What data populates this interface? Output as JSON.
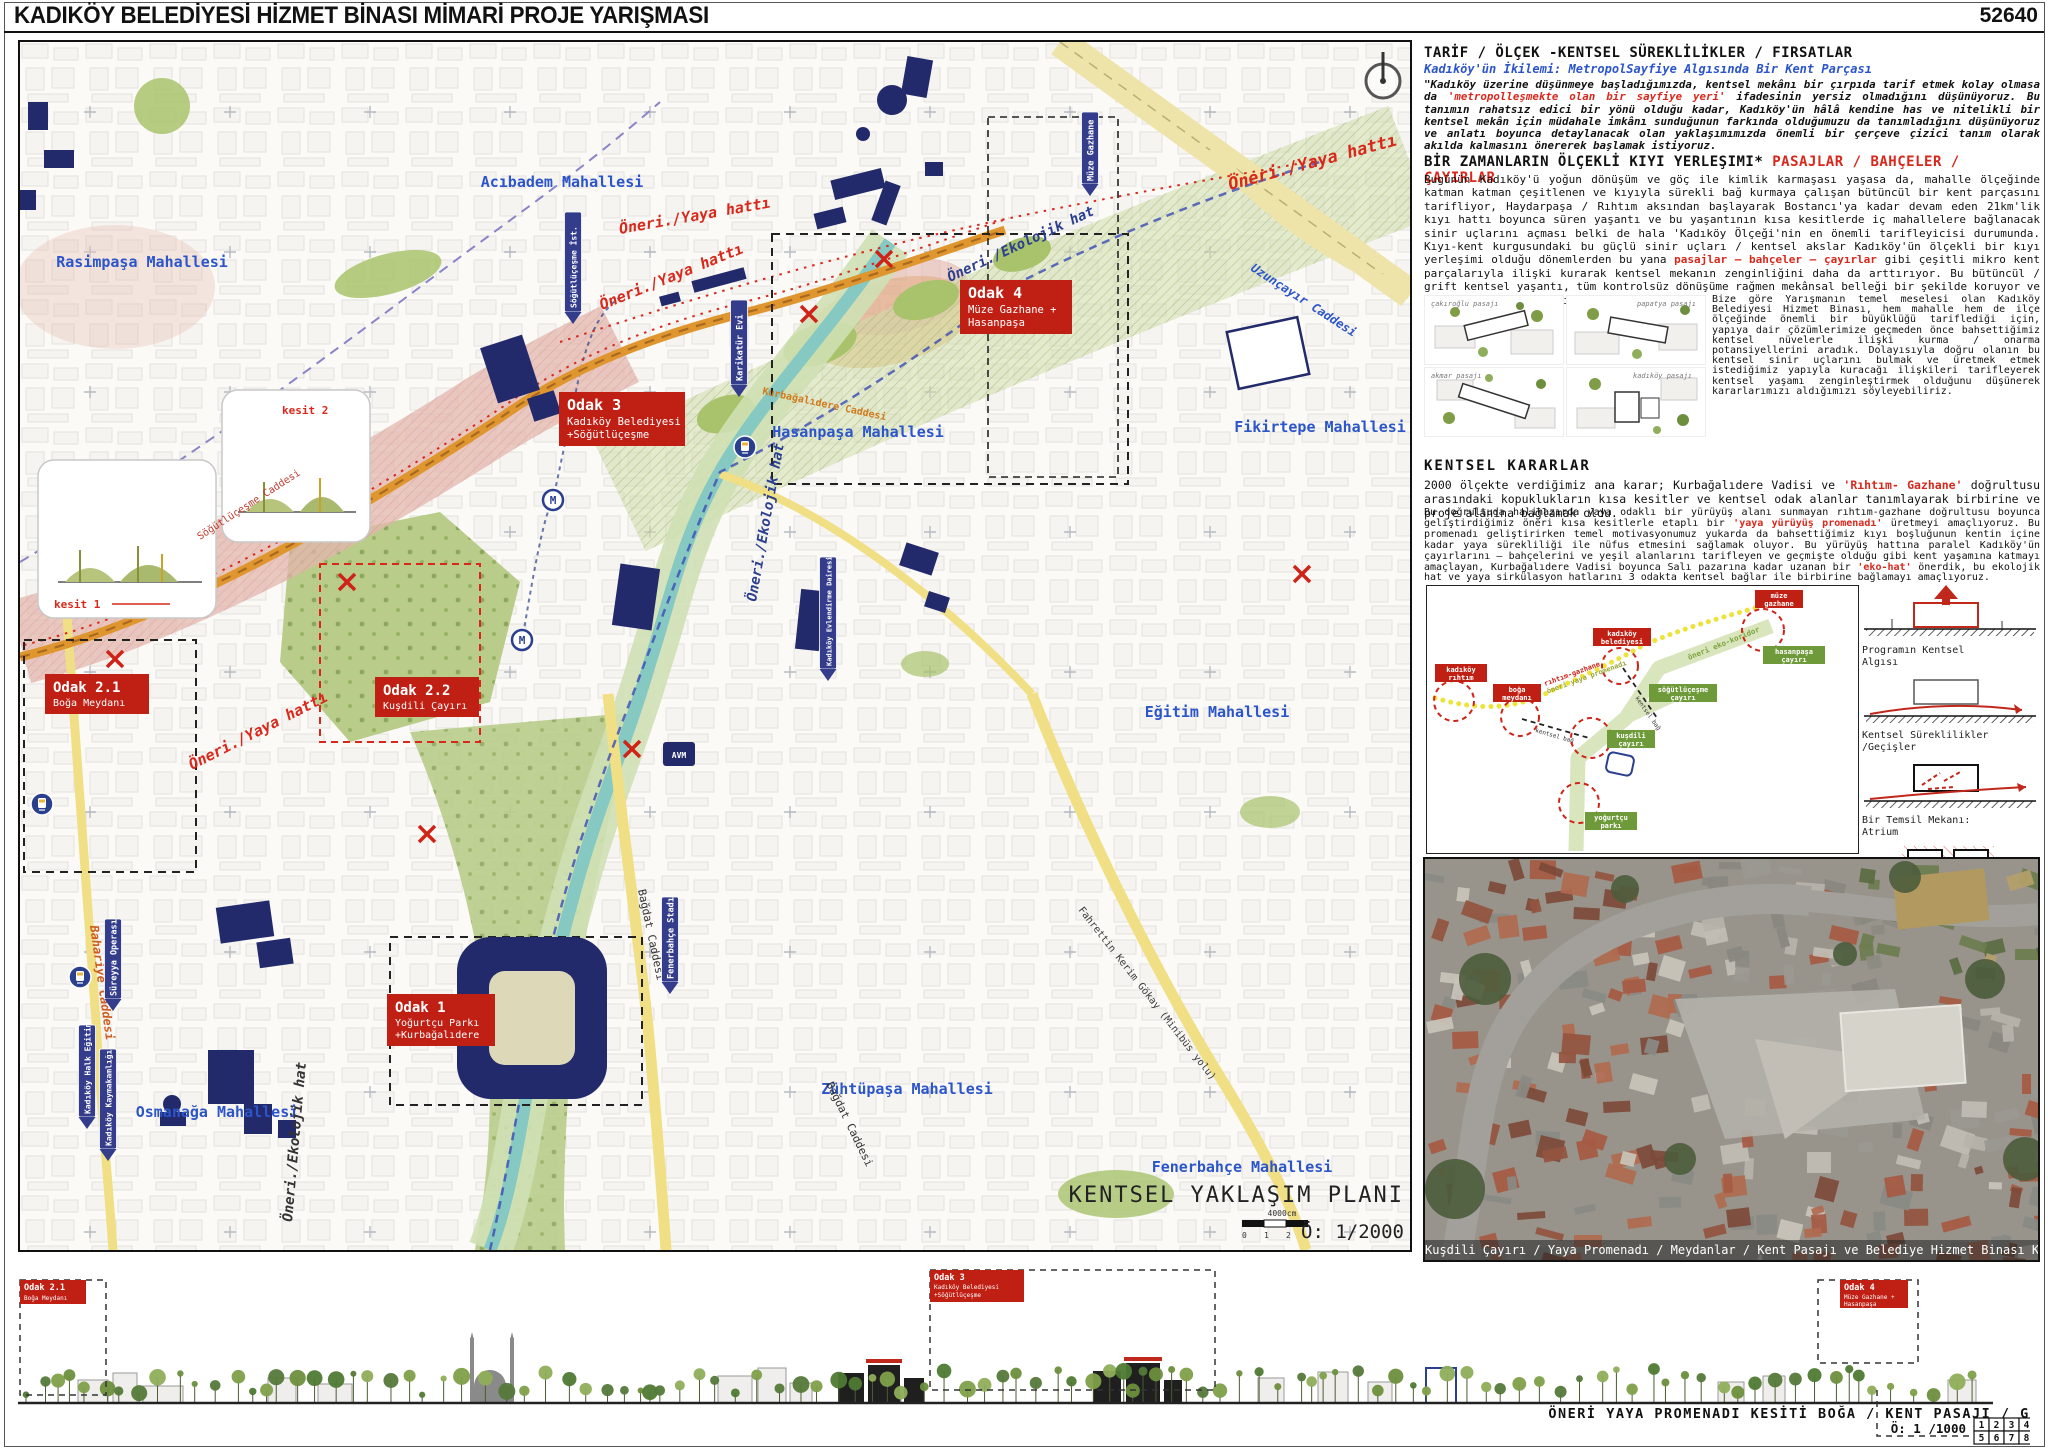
{
  "header": {
    "title": "KADIKÖY BELEDİYESİ HİZMET BİNASI MİMARİ PROJE YARIŞMASI",
    "code": "52640"
  },
  "map": {
    "plan_title": "KENTSEL YAKLAŞIM PLANI",
    "plan_scale": "Ö: 1/2000",
    "scalebar_label": "4000cm",
    "scalebar_ticks": [
      "0",
      "1",
      "2"
    ],
    "route_yaya": "Öneri./Yaya hattı",
    "route_eko": "Öneri./Ekolojik hat",
    "avm": "AVM",
    "kesit1": "kesit 1",
    "kesit2": "kesit 2",
    "neighborhoods": [
      {
        "name": "Acıbadem Mahallesi"
      },
      {
        "name": "Rasimpaşa Mahallesi"
      },
      {
        "name": "Hasanpaşa Mahallesi"
      },
      {
        "name": "Fikirtepe Mahallesi"
      },
      {
        "name": "Eğitim Mahallesi"
      },
      {
        "name": "Zühtüpaşa Mahallesi"
      },
      {
        "name": "Fenerbahçe Mahallesi"
      },
      {
        "name": "Osmanağa Mahallesi"
      }
    ],
    "streets": [
      {
        "name": "Uzunçayır Caddesi"
      },
      {
        "name": "Bağdat Caddesi"
      },
      {
        "name": "Bağdat Caddesi"
      },
      {
        "name": "Fahrettin Kerim Gökay (Minibüs yolu)"
      },
      {
        "name": "Bahariye Caddesi"
      },
      {
        "name": "Söğütlüçeşme Caddesi"
      },
      {
        "name": "Kurbağalıdere Caddesi"
      }
    ],
    "pois": [
      {
        "name": "Müze Gazhane"
      },
      {
        "name": "Söğütlüçeşme İst."
      },
      {
        "name": "Karikatür Evi"
      },
      {
        "name": "Kadıköy Evlendirme Dairesi"
      },
      {
        "name": "Fenerbahçe Stadı"
      },
      {
        "name": "Süreyya Operası"
      },
      {
        "name": "Kadıköy Halk Eğitim"
      },
      {
        "name": "Kadıköy Kaymakamlığı"
      }
    ],
    "odaks": [
      {
        "title": "Odak 4",
        "line1": "Müze Gazhane +",
        "line2": "Hasanpaşa"
      },
      {
        "title": "Odak 3",
        "line1": "Kadıköy Belediyesi",
        "line2": "+Söğütlüçeşme"
      },
      {
        "title": "Odak 2.1",
        "line1": "Boğa Meydanı",
        "line2": ""
      },
      {
        "title": "Odak 2.2",
        "line1": "Kuşdili Çayırı",
        "line2": ""
      },
      {
        "title": "Odak 1",
        "line1": "Yoğurtçu Parkı",
        "line2": "+Kurbağalıdere"
      }
    ]
  },
  "panel": {
    "s1_heading": "TARİF / ÖLÇEK -KENTSEL SÜREKLİLİKLER /  FIRSATLAR",
    "s1_sub": "Kadıköy'ün İkilemi: MetropolSayfiye Algısında Bir Kent Parçası",
    "p1_pre": "\"Kadıköy üzerine düşünmeye başladığımızda, kentsel mekânı bir çırpıda tarif etmek kolay olmasa da ",
    "p1_red": "'metropolleşmekte olan bir sayfiye yeri'",
    "p1_post": " ifadesinin yersiz olmadığını düşünüyoruz. Bu tanımın rahatsız edici bir yönü olduğu kadar, Kadıköy'ün hâlâ kendine has ve nitelikli bir kentsel mekân için müdahale imkânı sunduğunun farkında olduğumuzu da tanımladığını düşünüyoruz ve anlatı boyunca detaylanacak olan yaklaşımımızda önemli bir çerçeve çizici tanım olarak akılda kalmasını önererek başlamak istiyoruz.",
    "s2_heading_black": "BİR ZAMANLARIN ÖLÇEKLİ KIYI YERLEŞIMI* ",
    "s2_heading_red": "PASAJLAR / BAHÇELER / ÇAYIRLAR",
    "p2_pre": "Bugünün Kadıköy'ü yoğun dönüşüm ve göç ile kimlik karmaşası yaşasa da, mahalle ölçeğinde katman katman çeşitlenen ve kıyıyla sürekli bağ kurmaya çalışan bütüncül bir kent parçasını tarifliyor, Haydarpaşa / Rıhtım aksından başlayarak Bostancı'ya kadar devam eden 21km'lik kıyı hattı boyunca süren yaşantı ve bu yaşantının kısa kesitlerde iç mahallelere bağlanacak sinir uçlarını açması belki de hala 'Kadıköy Ölçeği'nin en önemli tarifleyicisi durumunda. Kıyı-kent kurgusundaki bu güçlü sinir uçları / kentsel akslar Kadıköy'ün ölçekli bir kıyı yerleşimi olduğu dönemlerden bu yana ",
    "p2_red": "pasajlar – bahçeler – çayırlar",
    "p2_post": " gibi çeşitli mikro kent parçalarıyla ilişki kurarak kentsel mekanın zenginliğini daha da arttırıyor. Bu bütüncül / grift kentsel yaşantı, tüm kontrolsüz dönüşüme rağmen mekânsal belleği bir şekilde koruyor ve özgün bir kent kimliği tarifliyor.",
    "pasajlar": [
      {
        "name": "çakıroğlu pasajı"
      },
      {
        "name": "papatya pasajı"
      },
      {
        "name": "akmar pasajı"
      },
      {
        "name": "kadıköy pasajı"
      }
    ],
    "side_para": "Bize göre Yarışmanın temel meselesi olan Kadıköy Belediyesi Hizmet Binası, hem mahalle hem de ilçe ölçeğinde önemli bir büyüklüğü tariflediği için, yapıya dair çözümlerimize geçmeden önce bahsettiğimiz kentsel nüvelerle ilişki kurma / onarma potansiyellerini aradık. Dolayısıyla doğru olanın bu kentsel sinir uçlarını bulmak ve üretmek etmek istediğimiz yapıyla kuracağı ilişkileri tarifleyerek kentsel yaşamı zenginleştirmek olduğunu düşünerek kararlarımızı aldığımızı söyleyebiliriz.",
    "s3_heading": "KENTSEL KARARLAR",
    "p3_pre": "2000  ölçekte  verdiğimiz  ana  karar;  Kurbağalıdere  Vadisi  ve  ",
    "p3_red": "'Rıhtım- Gazhane'",
    "p3_post": "  doğrultusu  arasındaki  kopuklukların  kısa  kesitler  ve  kentsel  odak  alanlar  tanımlayarak  birbirine  ve  proje  alanına  bağlamak  oldu.",
    "p4_pre": "Bu doğrultuda halihazırda yaya odaklı bir yürüyüş alanı sunmayan rıhtım-gazhane doğrultusu boyunca geliştirdiğimiz öneri kısa kesitlerle etaplı bir ",
    "p4_red1": "'yaya yürüyüş promenadı'",
    "p4_mid": " üretmeyi amaçlıyoruz. Bu promenadı geliştirirken temel motivasyonumuz yukarda da bahsettiğimiz kıyı boşluğunun kentin içine kadar yaya sürekliliği ile nüfus etmesini sağlamak oluyor. Bu yürüyüş hattına paralel Kadıköy'ün çayırlarını – bahçelerini ve yeşil alanlarını tarifleyen ve geçmişte olduğu gibi kent yaşamına katmayı amaçlayan, Kurbağalıdere Vadisi boyunca Salı pazarına kadar uzanan bir ",
    "p4_red2": "'eko-hat'",
    "p4_post": " önerdik, bu ekolojik hat ve yaya sirkülasyon hatlarını 3 odakta kentsel bağlar ile birbirine bağlamayı amaçlıyoruz."
  },
  "diagram": {
    "red_nodes": {
      "rihtim": [
        "kadıköy",
        "rıhtım"
      ],
      "boga": [
        "boğa",
        "meydanı"
      ],
      "belediye": [
        "kadıköy",
        "belediyesi"
      ],
      "gazhane": [
        "müze",
        "gazhane"
      ]
    },
    "green_nodes": {
      "hasanpasa": [
        "hasanpaşa",
        "çayırı"
      ],
      "sogutlucesme": [
        "söğütlüçeşme",
        "çayırı"
      ],
      "kusdili": [
        "kuşdili",
        "çayırı"
      ],
      "yogurtcu": [
        "yoğurtçu",
        "parkı"
      ]
    },
    "promenade_l1": "rıhtım-gazhane",
    "promenade_l2": "öneri yaya promenadı",
    "eko": "öneri eko-koridor",
    "bag": "kentsel bağ"
  },
  "sketch_captions": [
    {
      "l1": "Programın Kentsel",
      "l2": "Algısı"
    },
    {
      "l1": "Kentsel Süreklilikler",
      "l2": "/Geçişler"
    },
    {
      "l1": "Bir Temsil Mekanı:",
      "l2": "Atrium"
    },
    {
      "l1": "Kentsel Diyalog",
      "l2": "/Pasaj ve Zemin Hareketleri"
    }
  ],
  "photo_caption": "Kuşdili Çayırı / Yaya Promenadı / Meydanlar / Kent Pasajı ve Belediye Hizmet Binası Kuşbakışı Görünüşü",
  "section_strip": {
    "title": "ÖNERİ YAYA PROMENADI KESİTİ BOĞA / KENT PASAJI / GAZHANE",
    "scale": "Ö: 1 /1000",
    "sheets": [
      "1",
      "2",
      "3",
      "4",
      "5",
      "6",
      "7",
      "8"
    ],
    "odak21": {
      "t": "Odak 2.1",
      "s1": "Boğa Meydanı"
    },
    "odak3": {
      "t": "Odak 3",
      "s1": "Kadıköy Belediyesi",
      "s2": "+Söğütlüçeşme"
    },
    "odak4": {
      "t": "Odak 4",
      "s1": "Müze Gazhane +",
      "s2": "Hasanpaşa"
    }
  }
}
